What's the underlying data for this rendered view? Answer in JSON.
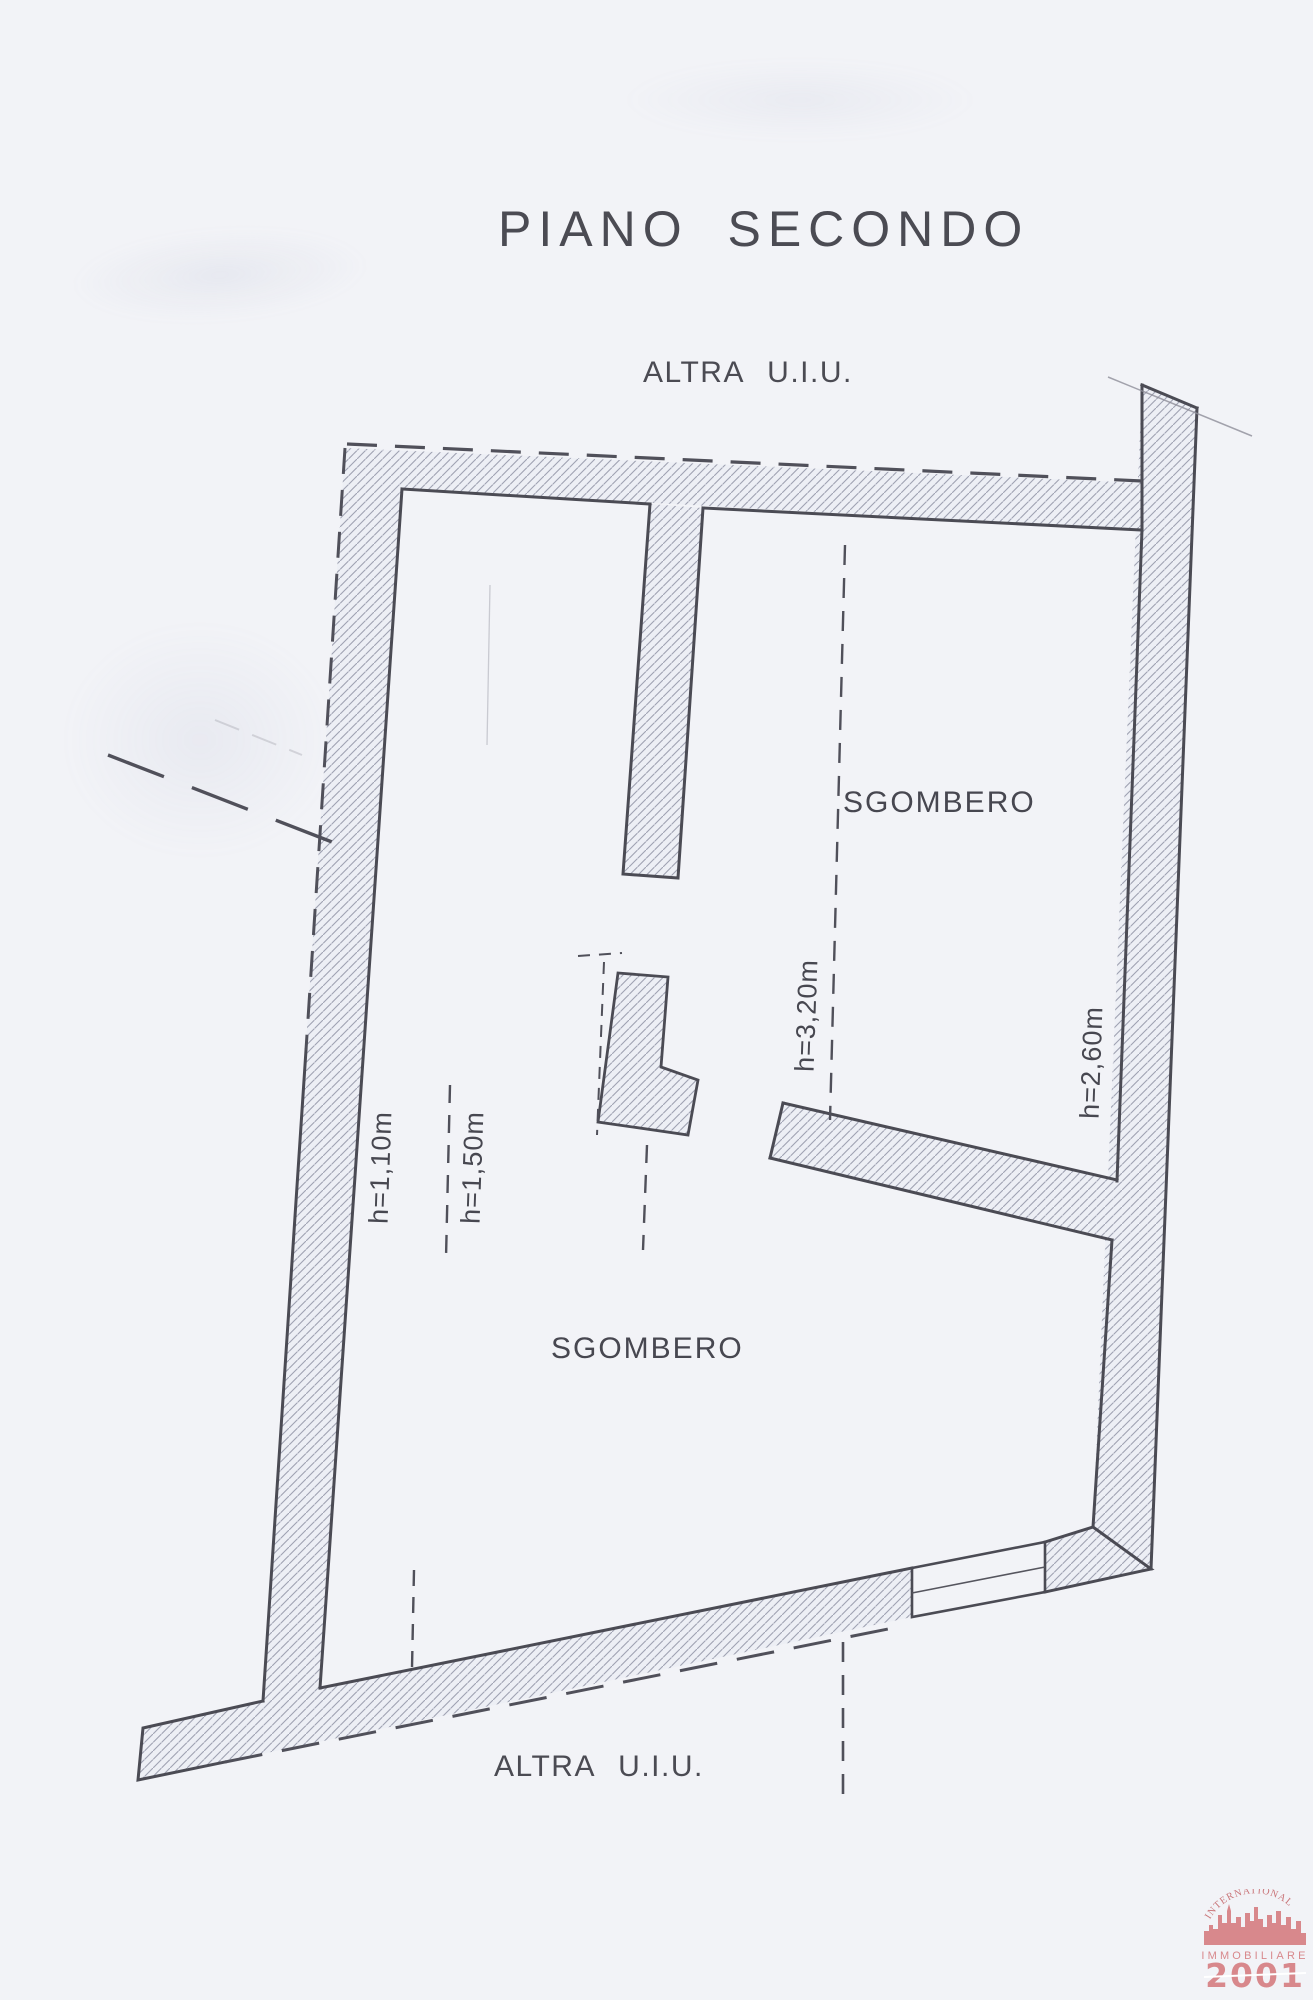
{
  "document": {
    "title": "PIANO SECONDO",
    "boundaries": {
      "top": "ALTRA U.I.U.",
      "bottom": "ALTRA U.I.U."
    },
    "rooms": {
      "upper": "SGOMBERO",
      "lower": "SGOMBERO"
    },
    "heights": {
      "left_outer": "h=1,10m",
      "left_inner": "h=1,50m",
      "center": "h=3,20m",
      "right": "h=2,60m"
    },
    "logo": {
      "arc": "INTERNATIONAL",
      "name": "IMMOBILIARE",
      "year": "2001"
    },
    "colors": {
      "paper": "#f2f3f7",
      "ink": "#4b4b54",
      "hatch_line": "#9fa2b2",
      "hatch_fill": "#edeff5",
      "logo_pink": "#d8888c"
    }
  }
}
